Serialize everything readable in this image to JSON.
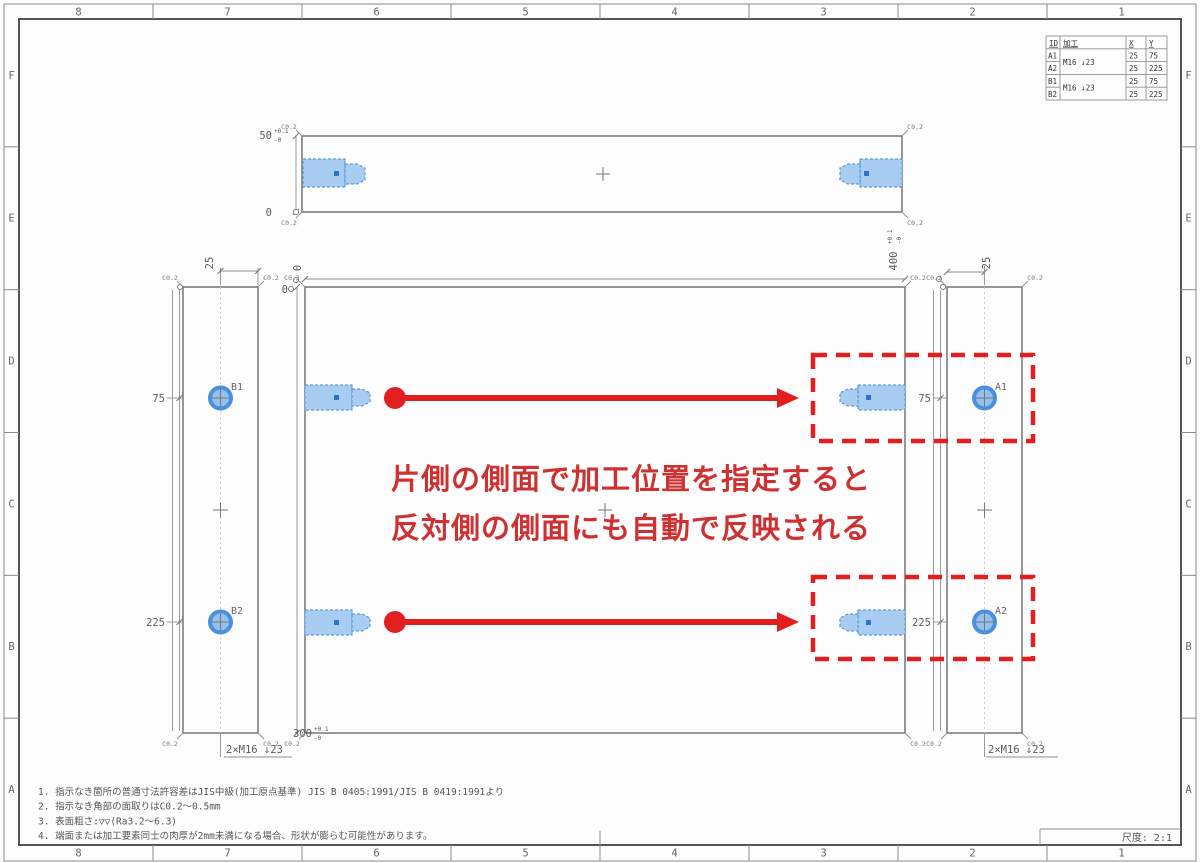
{
  "frame": {
    "zone_cols": [
      "8",
      "7",
      "6",
      "5",
      "4",
      "3",
      "2",
      "1"
    ],
    "zone_rows": [
      "F",
      "E",
      "D",
      "C",
      "B",
      "A"
    ]
  },
  "table": {
    "headers": [
      "ID",
      "加工",
      "X",
      "Y"
    ],
    "rows": [
      {
        "id": "A1",
        "x": "25",
        "y": "75"
      },
      {
        "id": "A2",
        "x": "25",
        "y": "225"
      },
      {
        "id": "B1",
        "x": "25",
        "y": "75"
      },
      {
        "id": "B2",
        "x": "25",
        "y": "225"
      }
    ],
    "groups": [
      {
        "machining": "M16 ↓23"
      },
      {
        "machining": "M16 ↓23"
      }
    ]
  },
  "dimensions": {
    "zero": "0",
    "offset": "25",
    "dim75": "75",
    "dim225": "225",
    "thickness": {
      "value": "50",
      "tol_upper": "+0.1",
      "tol_lower": "-0"
    },
    "width": {
      "value": "400",
      "tol_upper": "+0.1",
      "tol_lower": "-0"
    },
    "height": {
      "value": "300",
      "tol_upper": "+0.1",
      "tol_lower": "-0"
    },
    "chamfer": "C0.2"
  },
  "holes": {
    "a1": "A1",
    "a2": "A2",
    "b1": "B1",
    "b2": "B2",
    "thread_note": "2×M16 ↓23"
  },
  "callout": {
    "line1": "片側の側面で加工位置を指定すると",
    "line2": "反対側の側面にも自動で反映される"
  },
  "notes": [
    "1. 指示なき箇所の普通寸法許容差はJIS中級(加工原点基準) JIS B 0405:1991/JIS B 0419:1991より",
    "2. 指示なき角部の面取りはC0.2〜0.5mm",
    "3. 表面粗さ:▽▽(Ra3.2〜6.3)",
    "4. 端面または加工要素同士の肉厚が2mm未満になる場合、形状が膨らむ可能性があります。"
  ],
  "title_block": {
    "scale_label": "尺度: 2:1"
  },
  "colors": {
    "highlight_fill": "#a9cdf2",
    "highlight_stroke": "#5b9bd5",
    "hole_fill": "#93c0ef",
    "hole_stroke": "#4a90dc",
    "annotation_red": "#e31e1e",
    "line_gray": "#6b6b6b"
  }
}
